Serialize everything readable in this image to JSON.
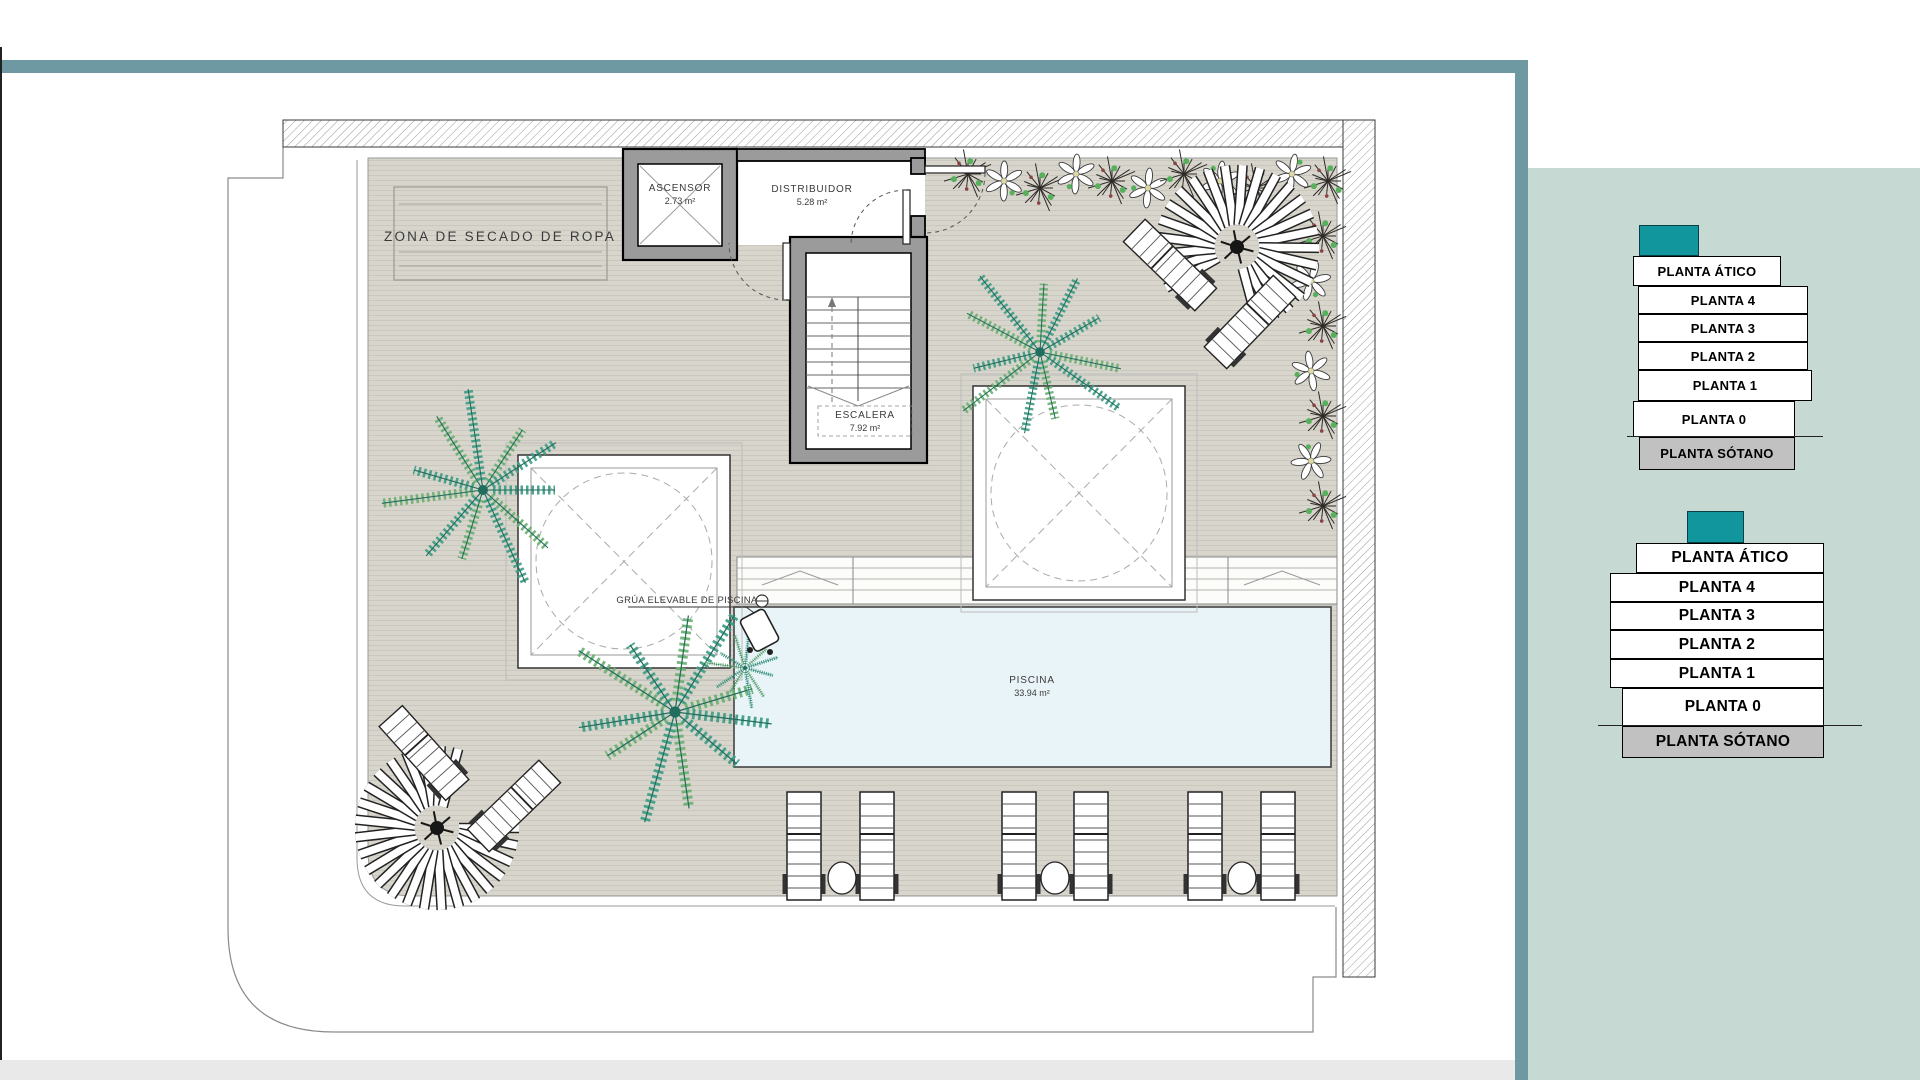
{
  "floor_plan": {
    "drying_zone_label": "ZONA DE SECADO DE ROPA",
    "pool_hoist_label": "GRÚA ELEVABLE DE PISCINA",
    "rooms": {
      "ascensor": {
        "name": "ASCENSOR",
        "area": "2.73 m²"
      },
      "distribuidor": {
        "name": "DISTRIBUIDOR",
        "area": "5.28 m²"
      },
      "escalera": {
        "name": "ESCALERA",
        "area": "7.92 m²"
      },
      "piscina": {
        "name": "PISCINA",
        "area": "33.94 m²"
      }
    }
  },
  "floor_selectors": {
    "top_stack": {
      "levels": [
        "PLANTA ÁTICO",
        "PLANTA 4",
        "PLANTA 3",
        "PLANTA 2",
        "PLANTA 1",
        "PLANTA 0",
        "PLANTA SÓTANO"
      ]
    },
    "bottom_stack": {
      "levels": [
        "PLANTA ÁTICO",
        "PLANTA 4",
        "PLANTA 3",
        "PLANTA 2",
        "PLANTA 1",
        "PLANTA 0",
        "PLANTA SÓTANO"
      ]
    }
  },
  "colors": {
    "frame_teal": "#6f99a2",
    "accent_teal": "#12969e",
    "panel_bg": "#c6d9d3",
    "sotano_gray": "#c1c1c1",
    "deck": "#d8d5cc",
    "deck_line": "#cac7be",
    "wall_gray": "#9b9b9b",
    "pool_blue": "#e9f4f8",
    "bottom_strip": "#e9e9e9",
    "palm_green_1": "#3f9d85",
    "palm_green_2": "#6cb072",
    "palm_rib": "#1f6e5e",
    "plant_dark": "#2e2b28",
    "plant_green": "#57b05c",
    "plant_berry": "#8a4343",
    "flower_center": "#ded9a2"
  }
}
